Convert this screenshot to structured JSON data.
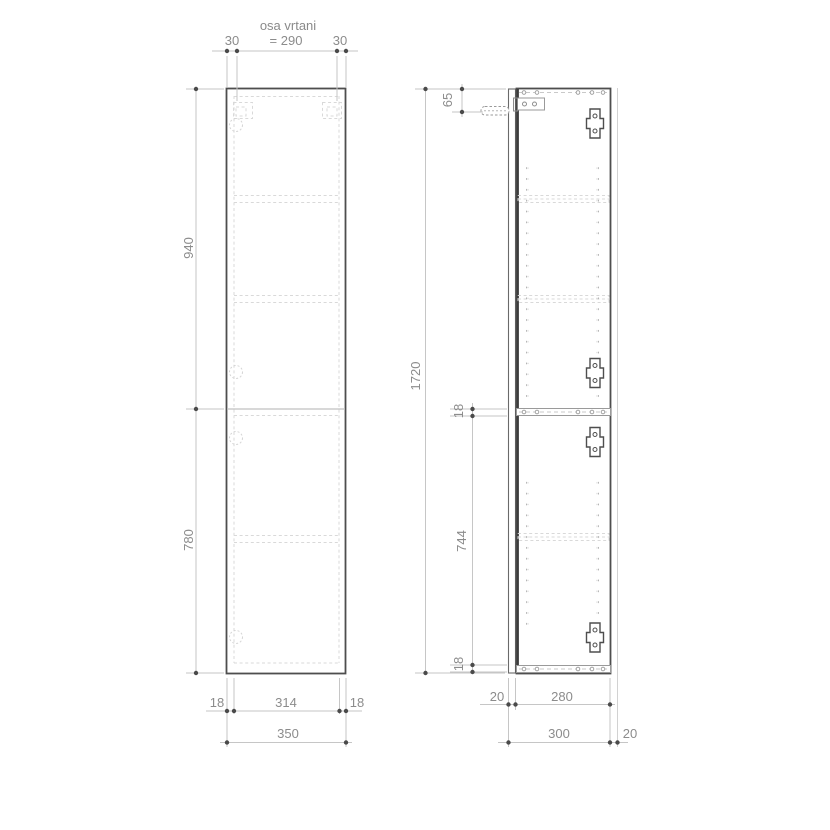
{
  "drawing": {
    "type": "cabinet technical drawing, front and side elevation",
    "units": "mm",
    "labels": {
      "drill_axis_title": "osa vrtani",
      "drill_axis_span": "= 290",
      "drill_axis_left": "30",
      "drill_axis_right": "30",
      "front_height_upper": "940",
      "front_height_lower": "780",
      "front_inner_left": "18",
      "front_inner_width": "314",
      "front_inner_right": "18",
      "front_total_width": "350",
      "side_total_height": "1720",
      "side_top_offset": "65",
      "side_mid_shelf_thickness": "18",
      "side_lower_inner_height": "744",
      "side_bottom_thickness": "18",
      "side_door_thickness": "20",
      "side_body_depth": "280",
      "side_total_depth": "300",
      "side_wall_gap": "20"
    },
    "colors": {
      "outline": "#4e4e4e",
      "hidden": "#d9d9d9",
      "dimension_line": "#c6c6c6",
      "dimension_dot": "#4a4a4a",
      "text": "#8c8c8c",
      "background": "#ffffff"
    }
  }
}
